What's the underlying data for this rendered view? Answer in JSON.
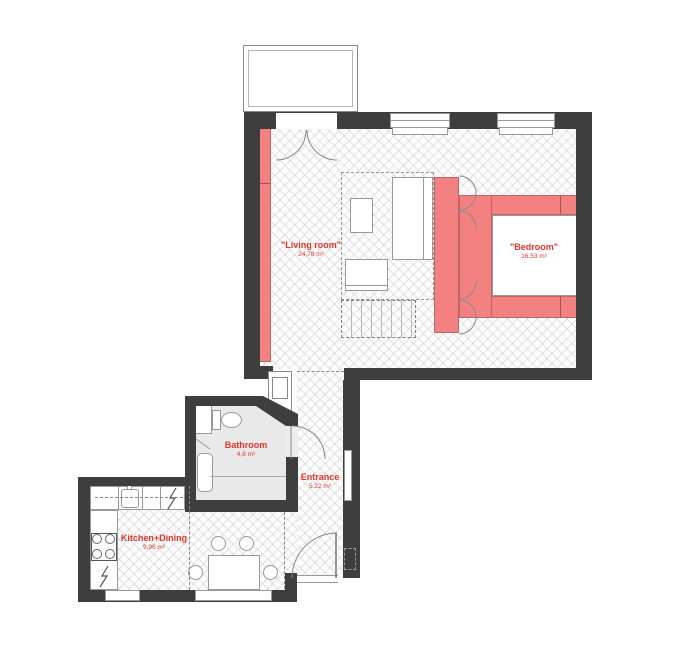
{
  "page": {
    "type": "apartment-floor-plan"
  },
  "rooms": [
    {
      "id": "living-room",
      "label": "\"Living room\"",
      "area": "24,78 m²"
    },
    {
      "id": "bedroom",
      "label": "\"Bedroom\"",
      "area": "16,53 m²"
    },
    {
      "id": "bathroom",
      "label": "Bathroom",
      "area": "4,8 m²"
    },
    {
      "id": "entrance",
      "label": "Entrance",
      "area": "5,22 m²"
    },
    {
      "id": "kitchen-dining",
      "label": "Kitchen+Dining",
      "area": "9,96 m²"
    }
  ],
  "icons": {
    "electric-bolt": "lightning-zigzag"
  },
  "colors": {
    "wall": "#3e3e3e",
    "accent": "#f48181",
    "label": "#e5352b",
    "outline": "#999999",
    "bath_floor": "#e9e9e9"
  }
}
